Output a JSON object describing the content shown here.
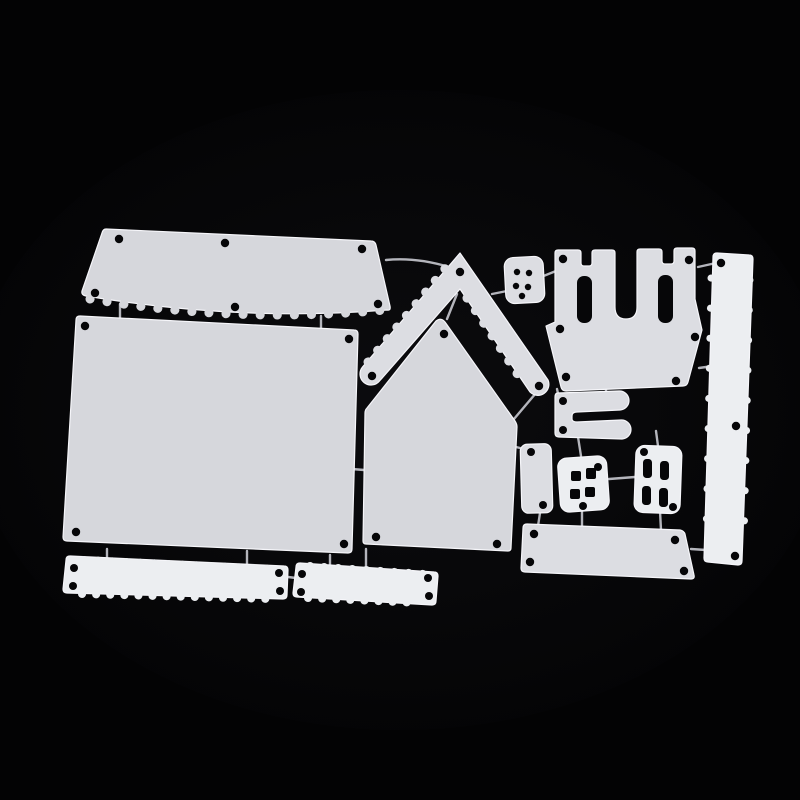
{
  "meta": {
    "type": "product-photo",
    "description": "Silver metal die-cutting template set shaped like house parts (roof panels, walls, chevron roof frame, castle battlement, windows, door, scalloped border strips) arranged on a black background",
    "piece_count": 14
  },
  "scene": {
    "background": "#030304",
    "vignette": "#3a3a46",
    "metal": "#d6d7dc",
    "metal_mid": "#dcdde2",
    "metal_bright": "#eceef1",
    "hole": "#060608",
    "edge": "#f6f6fa",
    "wire": "#b4b5bc"
  },
  "pieces": [
    {
      "id": "roof-scalloped-panel",
      "label": "wide scalloped roof panel"
    },
    {
      "id": "wall-rectangle-panel",
      "label": "large rectangular wall panel"
    },
    {
      "id": "roof-chevron-frame",
      "label": "chevron roof frame"
    },
    {
      "id": "house-front-pentagon",
      "label": "pentagon house front"
    },
    {
      "id": "button-square",
      "label": "small button square with five holes"
    },
    {
      "id": "castle-battlement",
      "label": "castle battlement with two towers"
    },
    {
      "id": "border-strip-vertical",
      "label": "vertical scalloped border strip"
    },
    {
      "id": "bracket-clip",
      "label": "C-shaped bracket clip"
    },
    {
      "id": "door-small",
      "label": "small door panel"
    },
    {
      "id": "window-four-pane-square",
      "label": "square four-pane window"
    },
    {
      "id": "window-four-pane-tall",
      "label": "tall four-pane window"
    },
    {
      "id": "base-rectangle",
      "label": "base rectangle panel"
    },
    {
      "id": "border-strip-long",
      "label": "long scalloped border strip"
    },
    {
      "id": "border-strip-short",
      "label": "short scalloped border strip"
    }
  ]
}
